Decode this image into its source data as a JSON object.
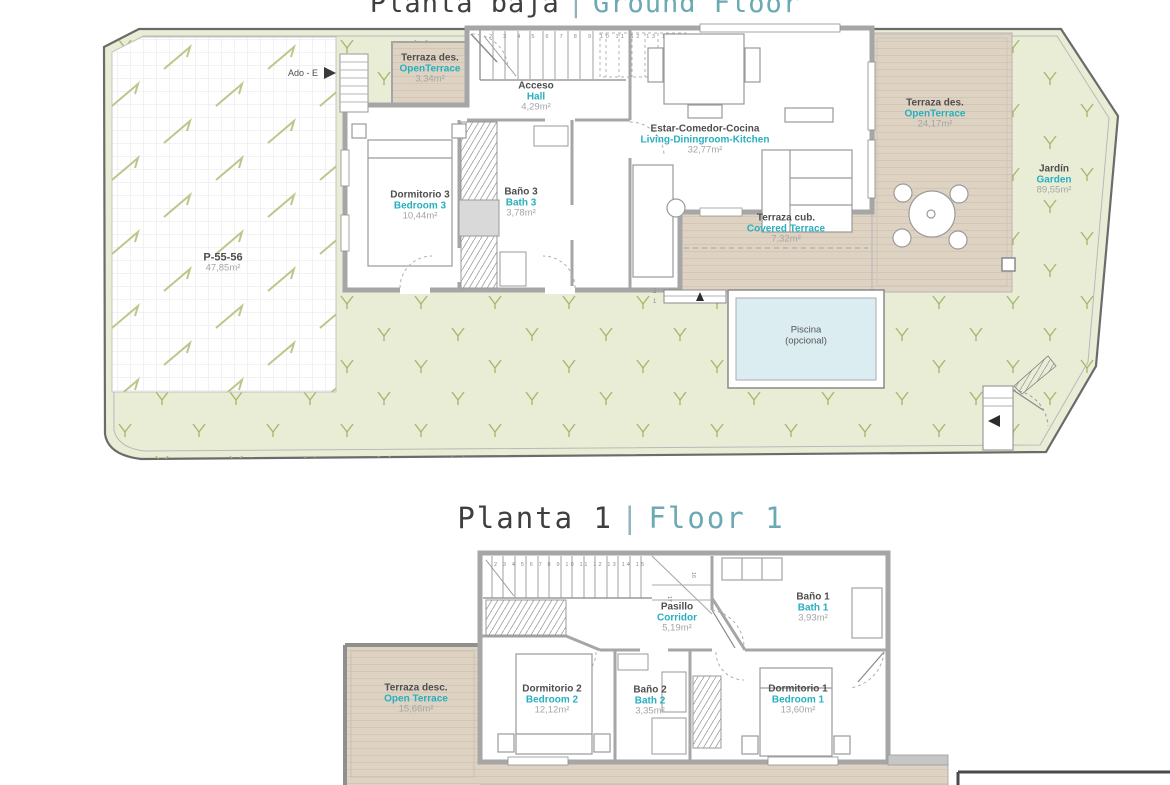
{
  "colors": {
    "accent_teal": "#2fb0c0",
    "title_teal": "#6ba9b4",
    "dark_text": "#3f3f3f",
    "muted_text": "#a5a5a5",
    "terrace_beige": "#ded3c2",
    "garden_green": "#e9edd5",
    "pool_blue": "#dcedf2",
    "wall_gray": "#a6a6a6"
  },
  "titles": {
    "ground": {
      "es": "Planta baja",
      "sep": "|",
      "en": "Ground Floor"
    },
    "first": {
      "es": "Planta 1",
      "sep": "|",
      "en": "Floor 1"
    }
  },
  "ground_floor": {
    "rooms": [
      {
        "id": "open-terrace-small",
        "name_es": "Terraza des.",
        "name_en": "OpenTerrace",
        "area": "3,34m²"
      },
      {
        "id": "hall",
        "name_es": "Acceso",
        "name_en": "Hall",
        "area": "4,29m²"
      },
      {
        "id": "bedroom-3",
        "name_es": "Dormitorio 3",
        "name_en": "Bedroom 3",
        "area": "10,44m²"
      },
      {
        "id": "bath-3",
        "name_es": "Baño 3",
        "name_en": "Bath 3",
        "area": "3,78m²"
      },
      {
        "id": "living-dining-kitchen",
        "name_es": "Estar-Comedor-Cocina",
        "name_en": "Living-Diningroom-Kitchen",
        "area": "32,77m²"
      },
      {
        "id": "covered-terrace",
        "name_es": "Terraza cub.",
        "name_en": "Covered Terrace",
        "area": "7,32m²"
      },
      {
        "id": "open-terrace-large",
        "name_es": "Terraza des.",
        "name_en": "OpenTerrace",
        "area": "24,17m²"
      },
      {
        "id": "garden",
        "name_es": "Jardín",
        "name_en": "Garden",
        "area": "89,55m²"
      }
    ],
    "parking": {
      "code": "P-55-56",
      "area": "47,85m²"
    },
    "pool": {
      "line1": "Piscina",
      "line2": "(opcional)"
    },
    "annotations": {
      "access_label": "Ado - E",
      "pool_step_upper": "2",
      "pool_step_lower": "1"
    },
    "stairs": {
      "run1": "2 3 4 5 6 7 8 9",
      "run2": "10 11 12 13 14 15",
      "turn": "16"
    }
  },
  "first_floor": {
    "rooms": [
      {
        "id": "corridor",
        "name_es": "Pasillo",
        "name_en": "Corridor",
        "area": "5,19m²"
      },
      {
        "id": "bath-1",
        "name_es": "Baño 1",
        "name_en": "Bath 1",
        "area": "3,93m²"
      },
      {
        "id": "open-terrace",
        "name_es": "Terraza desc.",
        "name_en": "Open Terrace",
        "area": "15,66m²"
      },
      {
        "id": "bedroom-2",
        "name_es": "Dormitorio 2",
        "name_en": "Bedroom 2",
        "area": "12,12m²"
      },
      {
        "id": "bath-2",
        "name_es": "Baño 2",
        "name_en": "Bath 2",
        "area": "3,35m²"
      },
      {
        "id": "bedroom-1",
        "name_es": "Dormitorio 1",
        "name_en": "Bedroom 1",
        "area": "13,60m²"
      }
    ],
    "stairs": {
      "run": "2 3 4 5 6 7 8 9 10 11 12 13 14 15",
      "turn1": "16",
      "turn2": "17"
    }
  }
}
